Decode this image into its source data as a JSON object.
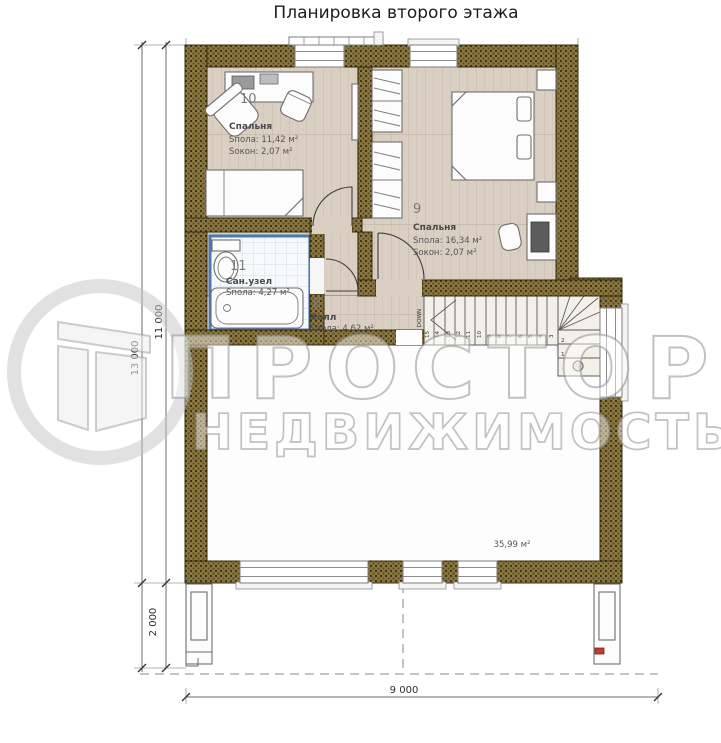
{
  "title": "Планировка второго этажа",
  "watermark": {
    "brand": "ПРОСТОР",
    "tagline": "НЕДВИЖИМОСТЬ"
  },
  "rooms": [
    {
      "number": "10",
      "name": "Спальня",
      "floor_area": "Sпола: 11,42 м²",
      "window_area": "Sокон:  2,07 м²"
    },
    {
      "number": "9",
      "name": "Спальня",
      "floor_area": "Sпола: 16,34 м²",
      "window_area": "Sокон:  2,07 м²"
    },
    {
      "number": "11",
      "name": "Сан.узел",
      "floor_area": "Sпола: 4,27 м²"
    },
    {
      "number": "8",
      "name": "Холл",
      "floor_area": "Sпола: 4,62 м²"
    }
  ],
  "open_area_label": "35,99 м²",
  "stairs": {
    "down_label": "DOWN",
    "top_step": "16",
    "run": [
      "15",
      "14",
      "13",
      "12",
      "11",
      "10",
      "9",
      "8",
      "7",
      "6",
      "5",
      "4",
      "3"
    ],
    "turn": [
      "2",
      "1"
    ]
  },
  "dimensions": {
    "total_height": "13 000",
    "house_height": "11 000",
    "porch_depth": "2 000",
    "width": "9 000"
  },
  "colors": {
    "wall": "#756432",
    "bathroom_accent": "#4d79b3",
    "floor_wood": "#d9cfc2"
  }
}
